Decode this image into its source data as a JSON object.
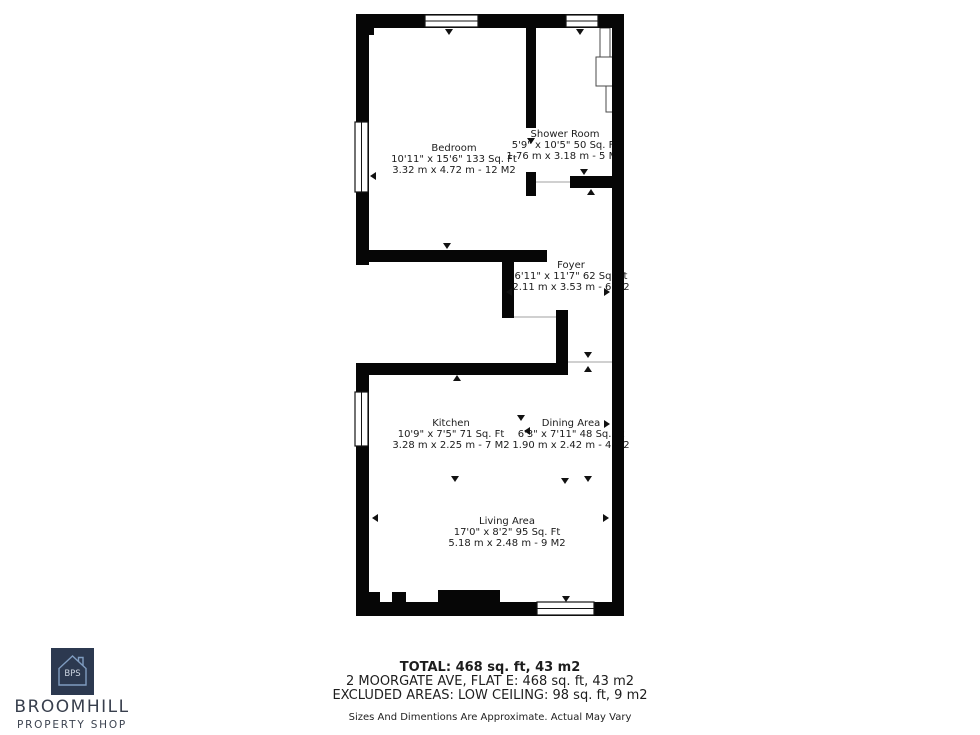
{
  "floorplan": {
    "wall_color": "#060606",
    "rooms": [
      {
        "id": "bedroom",
        "name": "Bedroom",
        "dims_ft": "10'11\" x 15'6\" 133 Sq. Ft",
        "dims_m": "3.32 m x 4.72 m - 12 M2"
      },
      {
        "id": "shower",
        "name": "Shower Room",
        "dims_ft": "5'9\" x 10'5\" 50 Sq. Ft",
        "dims_m": "1.76 m x 3.18 m - 5 M2"
      },
      {
        "id": "foyer",
        "name": "Foyer",
        "dims_ft": "6'11\" x 11'7\" 62 Sq. Ft",
        "dims_m": "2.11 m x 3.53 m - 6 M2"
      },
      {
        "id": "kitchen",
        "name": "Kitchen",
        "dims_ft": "10'9\" x 7'5\" 71 Sq. Ft",
        "dims_m": "3.28 m x 2.25 m - 7 M2"
      },
      {
        "id": "dining",
        "name": "Dining Area",
        "dims_ft": "6'3\" x 7'11\" 48 Sq. Ft",
        "dims_m": "1.90 m x 2.42 m - 4 M2"
      },
      {
        "id": "living",
        "name": "Living Area",
        "dims_ft": "17'0\" x 8'2\" 95 Sq. Ft",
        "dims_m": "5.18 m x 2.48 m - 9 M2"
      }
    ]
  },
  "footer": {
    "total": "TOTAL: 468 sq. ft, 43 m2",
    "address": "2 MOORGATE AVE, FLAT E: 468 sq. ft, 43 m2",
    "excluded": "EXCLUDED AREAS: LOW CEILING: 98 sq. ft, 9 m2",
    "disclaimer": "Sizes And Dimentions Are Approximate. Actual May Vary"
  },
  "logo": {
    "initials": "BPS",
    "name": "BROOMHILL",
    "tagline": "PROPERTY SHOP",
    "square_color": "#2c3950",
    "house_outline_color": "#7f9cc0",
    "text_color": "#383f4d"
  }
}
